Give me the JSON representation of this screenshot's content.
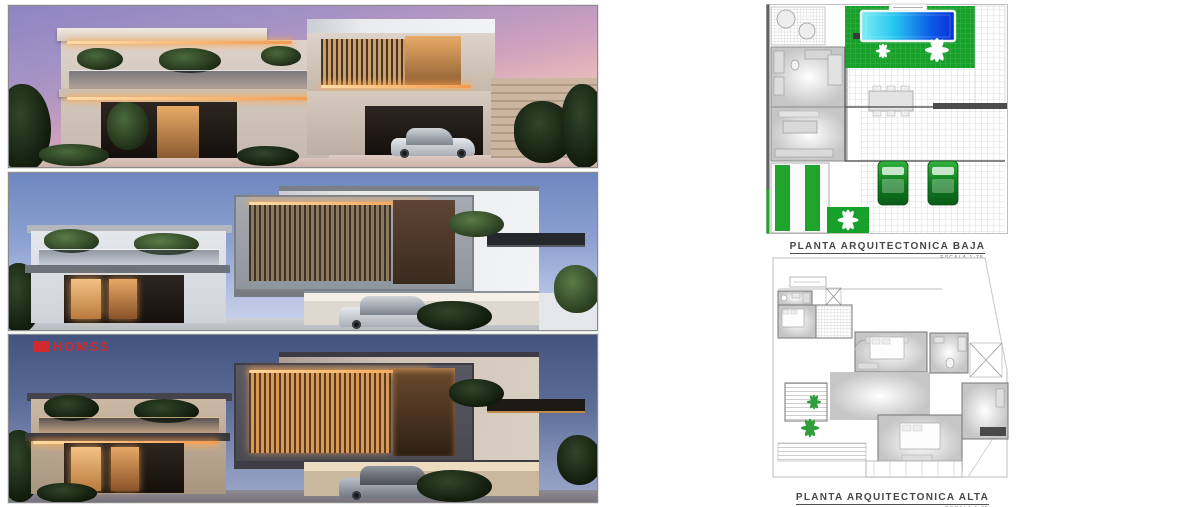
{
  "watermark": {
    "label": "HOMSS",
    "color": "#cf2b2f"
  },
  "renders": [
    {
      "name": "dusk-exterior-render"
    },
    {
      "name": "evening-exterior-render"
    },
    {
      "name": "night-exterior-render"
    }
  ],
  "floor_plans": {
    "ground": {
      "title": "PLANTA ARQUITECTONICA BAJA",
      "scale_note": "ESCALA 1:75"
    },
    "upper": {
      "title": "PLANTA ARQUITECTONICA ALTA",
      "scale_note": "ESCALA 1:75"
    }
  },
  "colors": {
    "lawn_green": "#17a12b",
    "pool_light": "#7ceef5",
    "pool_dark": "#0a2fd6",
    "car_green": "#0f7d1f",
    "plan_line": "#8a8a8a",
    "title_text": "#474747"
  }
}
